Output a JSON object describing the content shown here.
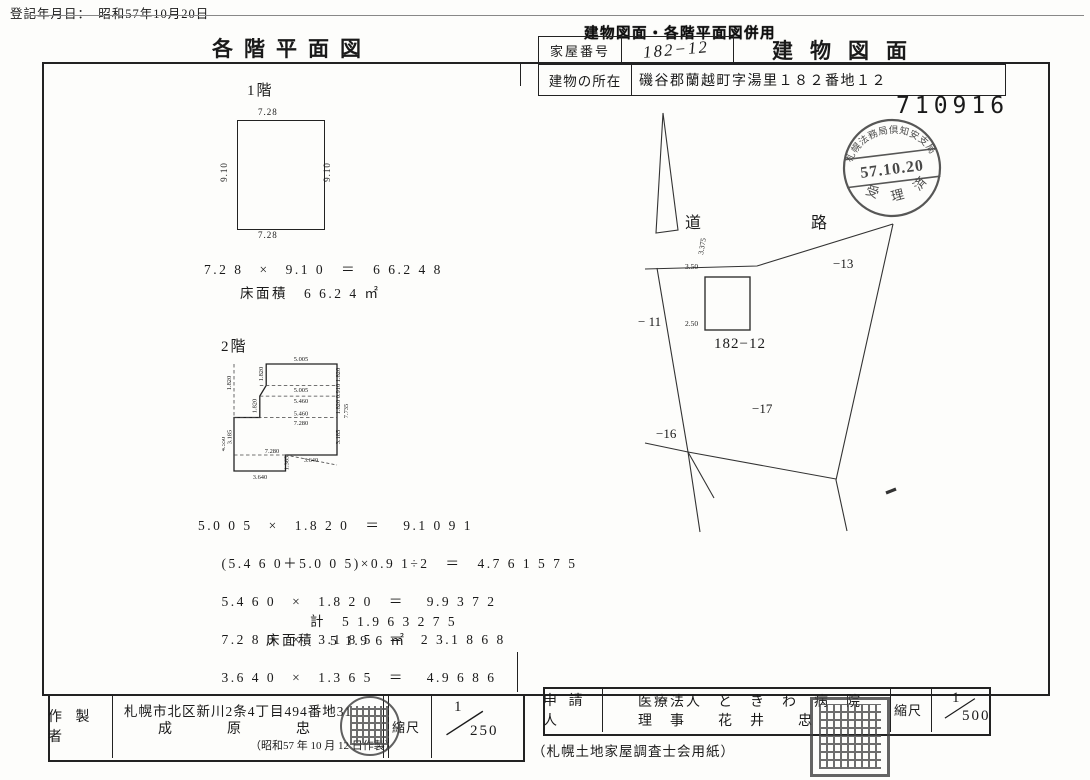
{
  "document": {
    "registration_date": "登記年月日：　昭和57年10月20日",
    "serial_number": "710916",
    "paper_note": "（札幌土地家屋調査士会用紙）"
  },
  "header": {
    "overprint_stamp": "建物図面・各階平面図併用",
    "left_title": "各階平面図",
    "right_title": "建物図面",
    "house_number_label": "家屋番号",
    "house_number_value": "182−12",
    "location_label": "建物の所在",
    "location_value": "磯谷郡蘭越町字湯里１８２番地１２"
  },
  "receipt_stamp": {
    "arc_text": "札幌法務局倶知安支局",
    "date": "57.10.20",
    "bottom_text": "受 理 済"
  },
  "floor1": {
    "label": "1階",
    "width_top": "7.28",
    "width_bottom": "7.28",
    "height_left": "9.10",
    "height_right": "9.10",
    "calc": "7.2 8　×　9.1 0　＝　6 6.2 4 8",
    "area": "床面積　6 6.2 4 ㎡"
  },
  "floor2": {
    "label": "2階",
    "dims": {
      "top": "5.005",
      "r1": "1.820",
      "r2": "0.910",
      "r3": "1.820",
      "r_total": "7.735",
      "r4": "3.185",
      "l1": "1.820",
      "l2": "1.820",
      "l3": "1.820",
      "l_total": "4.550",
      "l4": "3.185",
      "m1": "5.005",
      "m2": "5.460",
      "m3": "5.460",
      "m4": "7.280",
      "m5": "7.280",
      "m6": "3.640",
      "notch": "1.365",
      "bottom": "3.640"
    },
    "calc_lines": [
      "5.0 0 5　×　1.8 2 0　＝　 9.1 0 9 1",
      "(5.4 6 0＋5.0 0 5)×0.9 1÷2　＝　4.7 6 1 5 7 5",
      "5.4 6 0　×　1.8 2 0　＝　 9.9 3 7 2",
      "7.2 8 0　×　3.1 8 5　＝　2 3.1 8 6 8",
      "3.6 4 0　×　1.3 6 5　＝　 4.9 6 8 6"
    ],
    "total": "計　5 1.9 6 3 2 7 5",
    "area": "床面積　5 1.9 6 ㎡"
  },
  "site_plan": {
    "road": "道　　路",
    "parcels": {
      "p13": "−13",
      "p11": "− 11",
      "main": "182−12",
      "p17": "−17",
      "p16": "−16"
    },
    "dims": {
      "d1": "3.50",
      "d2": "2.50",
      "d3": "3.375"
    }
  },
  "maker": {
    "label": "作 製 者",
    "address": "札幌市北区新川2条4丁目494番地31",
    "name": "成　　原　　忠",
    "date_note": "（昭和57 年 10 月 12 日作製）",
    "scale_label": "縮尺",
    "scale_num": "1",
    "scale_den": "250"
  },
  "applicant": {
    "label": "申 請 人",
    "line1": "医療法人　と　き　わ　病　院",
    "line2": "理　事　　花　井　　忠",
    "scale_label": "縮尺",
    "scale_num": "1",
    "scale_den": "500"
  }
}
